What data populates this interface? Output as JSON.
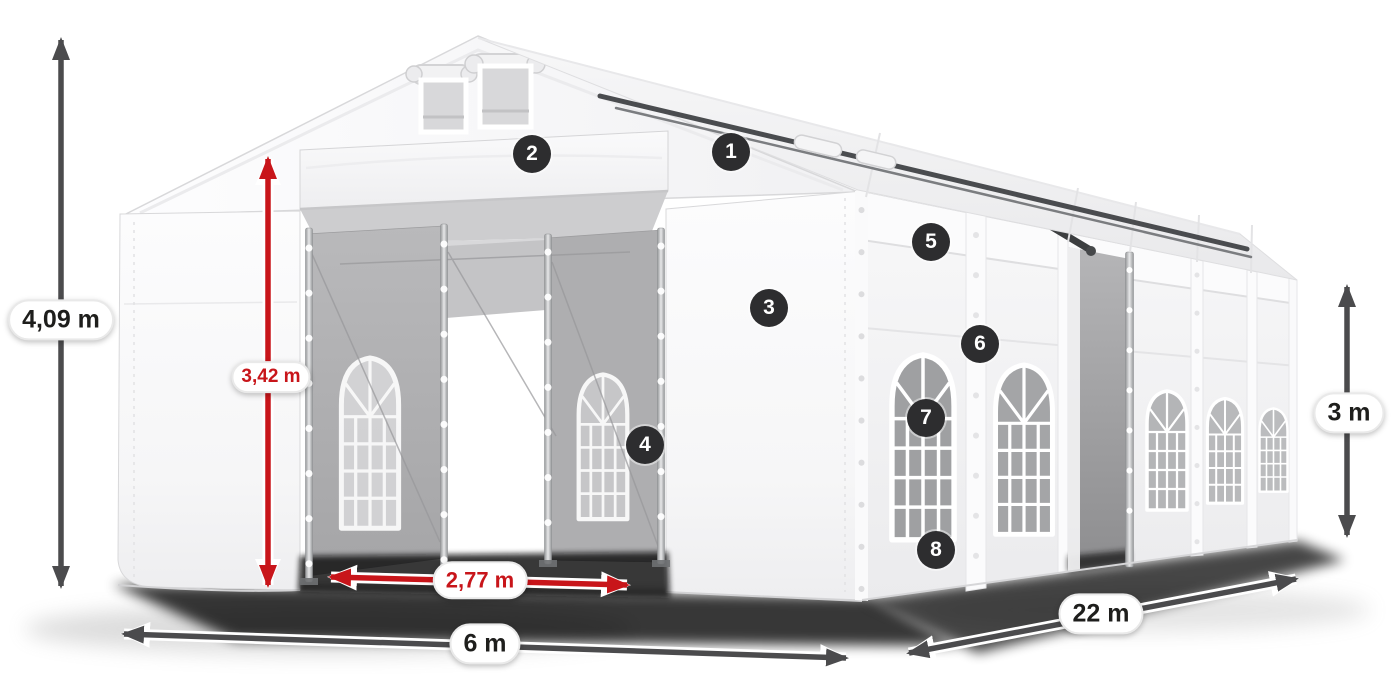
{
  "diagram": {
    "subject": "White PVC marquee tent 6 x 22 m with dimension annotations",
    "measurements": {
      "total_height": "4,09 m",
      "entrance_height": "3,42 m",
      "entrance_width": "2,77 m",
      "width": "6 m",
      "length": "22 m",
      "side_wall_height": "3 m"
    },
    "callouts": [
      "1",
      "2",
      "3",
      "4",
      "5",
      "6",
      "7",
      "8"
    ],
    "colors": {
      "dimension_red": "#c8151a",
      "dimension_dark": "#4b4b4d",
      "badge_background": "#2d2d2f",
      "badge_text": "#ffffff",
      "label_background": "#ffffff",
      "label_text_dark": "#1e1e1c"
    }
  }
}
